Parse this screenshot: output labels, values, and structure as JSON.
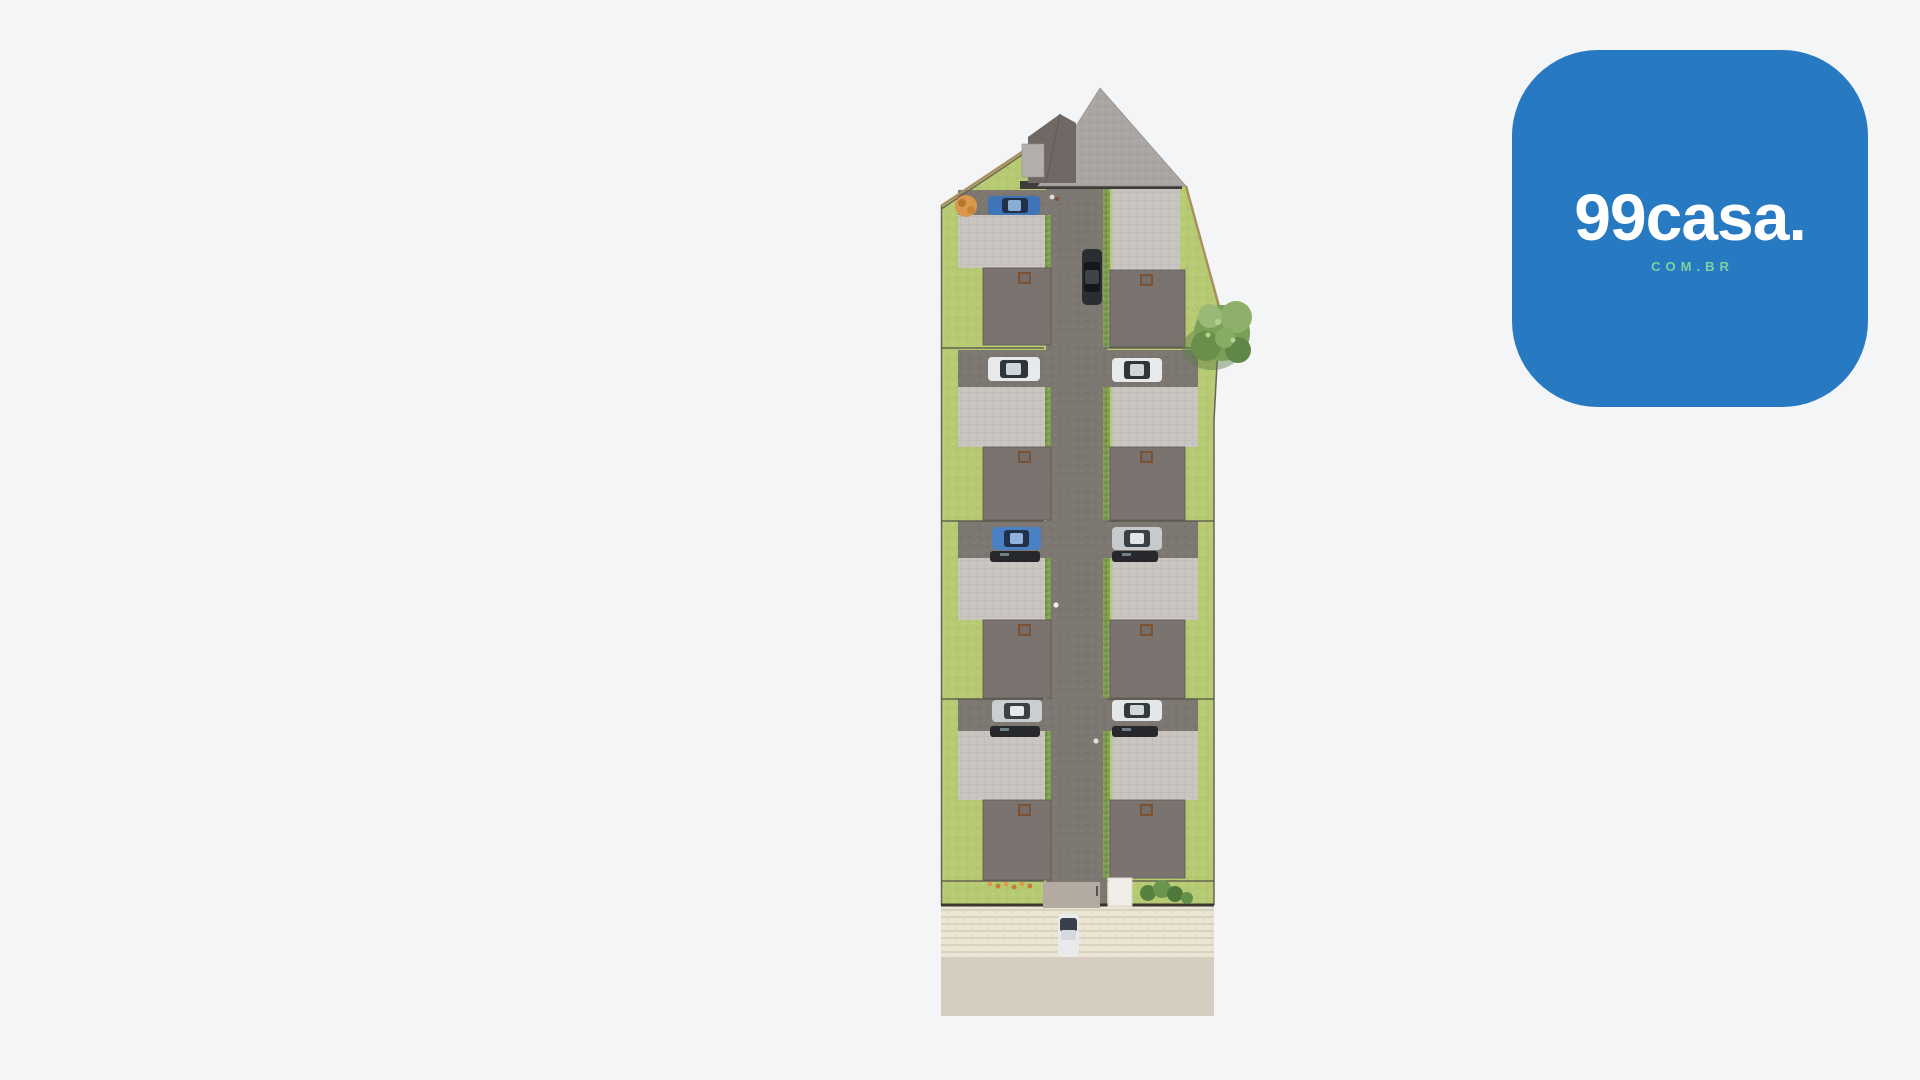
{
  "colors": {
    "page-bg": "#f4f5f7",
    "brand-blue": "#2779c2",
    "logo-text": "#ffffff",
    "logo-domain": "#7fd0a2",
    "lawn": "#b6c973",
    "road": "#7d7772",
    "patio": "#cac6c2",
    "roof": "#7b7370",
    "sidewalk": "#ebe5d3",
    "street": "#d5cec0"
  },
  "logo": {
    "wordmark": "99casa.",
    "domain_label": "COM.BR"
  },
  "scene": {
    "type": "aerial-site-plan-render",
    "residential_units": 8,
    "unit_columns": 2,
    "unit_rows": 4,
    "parked_car_colors": [
      "blue",
      "white",
      "white",
      "blue",
      "silver",
      "silver",
      "white"
    ],
    "moving_car_colors": [
      "dark-gray",
      "white"
    ],
    "landscape": [
      "lawn",
      "street-tree",
      "shrubs",
      "orange-flowering-bushes",
      "road-hedges"
    ],
    "features": [
      "central-driveway",
      "gabled-entrance-building",
      "perimeter-fence",
      "rear-gate",
      "sidewalk",
      "street",
      "pedestrians"
    ]
  }
}
